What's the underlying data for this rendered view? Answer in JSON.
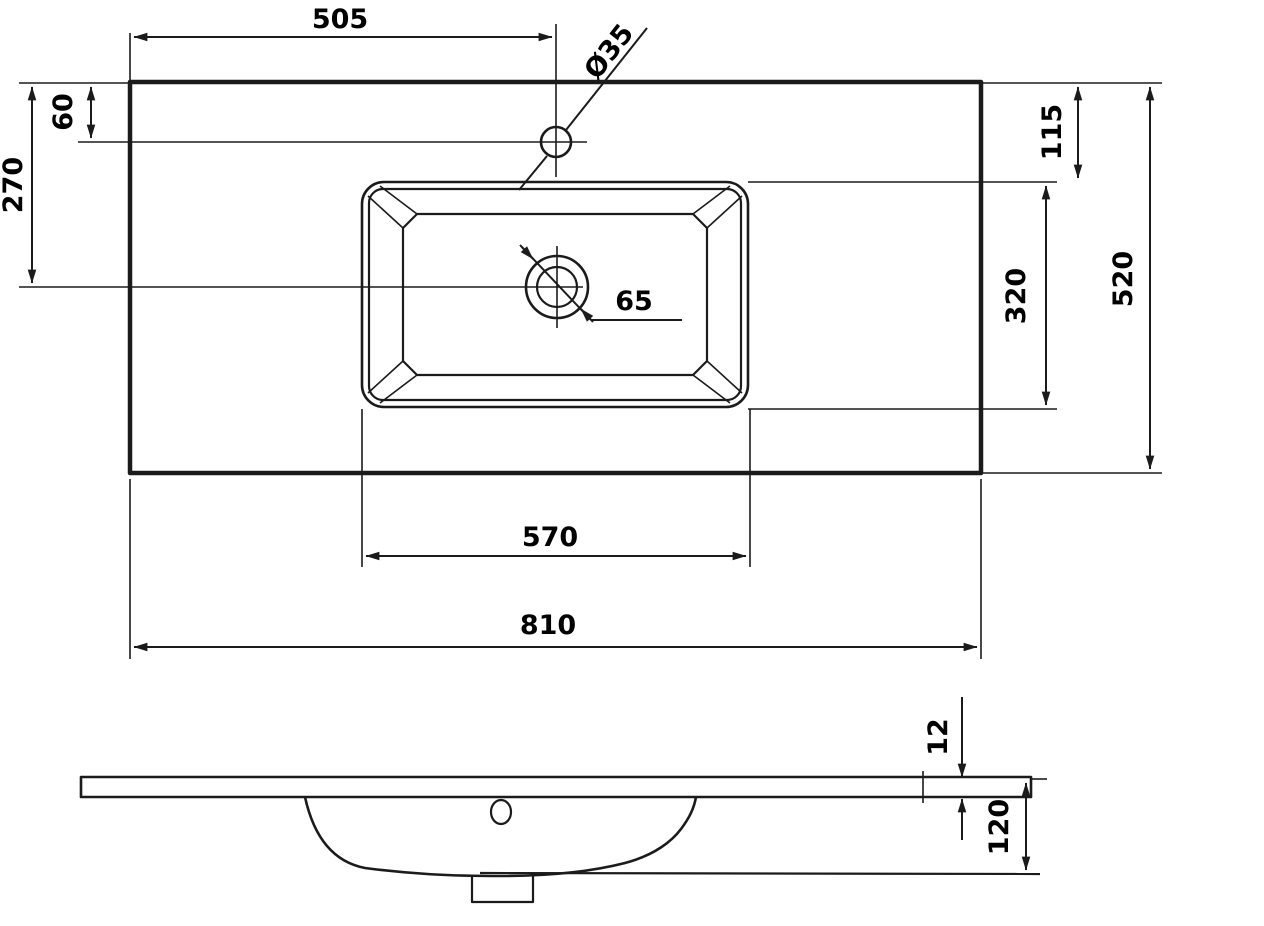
{
  "drawing": {
    "background_color": "#ffffff",
    "line_color": "#1b1b1b",
    "dims": {
      "top_width": "505",
      "faucet_hole": "Ø35",
      "faucet_offset": "60",
      "drain_offset": "270",
      "rim_offset_right": "115",
      "basin_depth_plan": "320",
      "overall_depth": "520",
      "drain_hole": "65",
      "basin_width": "570",
      "overall_width": "810",
      "slab_thickness": "12",
      "overall_height": "120"
    }
  }
}
